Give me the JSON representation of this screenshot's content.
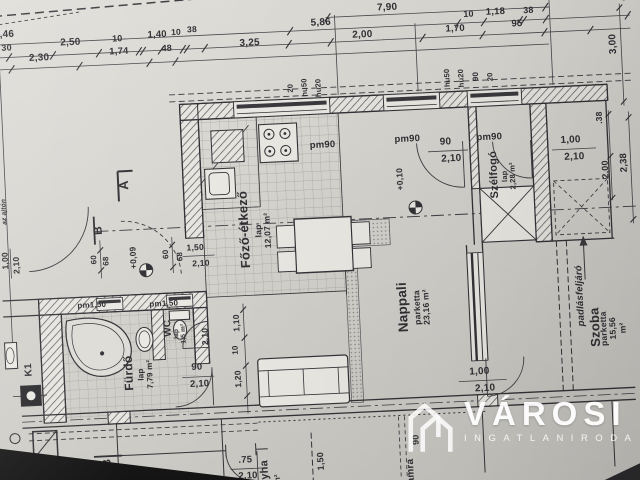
{
  "document": {
    "kind": "architectural floor plan photo",
    "language": "Hungarian"
  },
  "colors": {
    "paper": "#d8d6d1",
    "ink": "#3a3a3e",
    "watermark": "#ffffff",
    "window_fill": "#3a3a3e"
  },
  "watermark": {
    "brand": "VÁROSI",
    "subtitle": "INGATLANIRODA",
    "icon": "twin-tower-building-icon"
  },
  "rooms": [
    {
      "name": "Főző-étkező",
      "floor": "lap",
      "area": "12,07 m²"
    },
    {
      "name": "Nappali",
      "floor": "parketta",
      "area": "23,16 m²"
    },
    {
      "name": "Szélfogó",
      "floor": "lap",
      "area": "2,28 m²"
    },
    {
      "name": "Fürdő",
      "floor": "lap",
      "area": "7,79 m²"
    },
    {
      "name": "WC",
      "floor": "lap",
      "area": "1,5 m²"
    },
    {
      "name": "Szoba",
      "floor": "parketta",
      "area": "15,56 m²"
    },
    {
      "name": "Konyha",
      "floor": "",
      "area": ""
    },
    {
      "name": "kamra",
      "floor": "",
      "area": ""
    }
  ],
  "annotations": {
    "attic_access": "padlásfeljáró",
    "level_markers": [
      "+0,10",
      "+0,09"
    ],
    "section_markers": [
      "A",
      "B"
    ],
    "chimney": "K1",
    "door_specs": [
      "pm90",
      "90/2,10",
      "1,00/2,10",
      "pm1,50",
      "90/2,10",
      ".75/2,10",
      "1,50/2,10"
    ],
    "note": "az ajtón"
  },
  "plan": {
    "labels": [
      {
        "t": "7,90",
        "x": 398,
        "y": 11,
        "n": "dim-790"
      },
      {
        "t": "10",
        "x": 479,
        "y": 22,
        "s": 9
      },
      {
        "t": "1,18",
        "x": 506,
        "y": 21,
        "s": 9.5
      },
      {
        "t": "38",
        "x": 539,
        "y": 21,
        "s": 9
      },
      {
        "t": "8,46",
        "x": 14,
        "y": 20
      },
      {
        "t": "5,86",
        "x": 331,
        "y": 23
      },
      {
        "t": "95",
        "x": 527,
        "y": 34,
        "s": 9.5
      },
      {
        "t": "30",
        "x": 16,
        "y": 34,
        "s": 9
      },
      {
        "t": "2,50",
        "x": 80,
        "y": 31
      },
      {
        "t": "10",
        "x": 127,
        "y": 30,
        "s": 9
      },
      {
        "t": "1,40",
        "x": 167,
        "y": 28,
        "s": 9.5
      },
      {
        "t": "10",
        "x": 186,
        "y": 26,
        "s": 8.5
      },
      {
        "t": "38",
        "x": 202,
        "y": 24,
        "s": 8.5
      },
      {
        "t": "3,25",
        "x": 259,
        "y": 40
      },
      {
        "t": "2,00",
        "x": 372,
        "y": 37
      },
      {
        "t": "1,70",
        "x": 465,
        "y": 36,
        "s": 9.5
      },
      {
        "t": "2,30",
        "x": 48,
        "y": 45
      },
      {
        "t": "1,74",
        "x": 128,
        "y": 43,
        "s": 9.5
      },
      {
        "t": "48",
        "x": 176,
        "y": 42,
        "s": 9
      },
      {
        "t": "5",
        "x": 635,
        "y": 13,
        "s": 9.5
      },
      {
        "t": "3,00",
        "x": 622,
        "y": 58,
        "r": -90
      },
      {
        "t": ".38",
        "x": 605,
        "y": 131,
        "r": -90,
        "s": 8.5
      },
      {
        "t": "2,00",
        "x": 609,
        "y": 183,
        "r": -90,
        "s": 9
      },
      {
        "t": "2,38",
        "x": 628,
        "y": 177,
        "r": -90,
        "s": 9.5
      },
      {
        "t": "20",
        "x": 298,
        "y": 87,
        "r": -90,
        "s": 7.5
      },
      {
        "t": "hu50",
        "x": 312,
        "y": 87,
        "r": -90,
        "s": 7.5
      },
      {
        "t": "hu20",
        "x": 326,
        "y": 88,
        "r": -90,
        "s": 7.5
      },
      {
        "t": "hu50",
        "x": 455,
        "y": 84,
        "r": -90,
        "s": 7.5
      },
      {
        "t": "hu20",
        "x": 469,
        "y": 85,
        "r": -90,
        "s": 7.5
      },
      {
        "t": "90",
        "x": 484,
        "y": 84,
        "r": -90,
        "s": 8
      },
      {
        "t": "20",
        "x": 498,
        "y": 85,
        "r": -90,
        "s": 7.5
      },
      {
        "t": "pm90",
        "x": 327,
        "y": 146,
        "s": 9.5,
        "n": "window-spec-pm90"
      },
      {
        "t": "pm90",
        "x": 412,
        "y": 144,
        "s": 9.5,
        "n": "window-spec-pm90"
      },
      {
        "t": "90",
        "x": 450,
        "y": 148,
        "s": 10
      },
      {
        "t": "2,10",
        "x": 455,
        "y": 165,
        "s": 10
      },
      {
        "t": "pm90",
        "x": 494,
        "y": 146,
        "s": 9.5,
        "n": "window-spec-pm90"
      },
      {
        "t": "1,00",
        "x": 575,
        "y": 152,
        "s": 10
      },
      {
        "t": "2,10",
        "x": 578,
        "y": 169,
        "s": 10
      },
      {
        "t": "1,00",
        "x": 473,
        "y": 379,
        "s": 10
      },
      {
        "t": "2,10",
        "x": 478,
        "y": 396,
        "s": 10
      },
      {
        "t": "pm1,50",
        "x": 89,
        "y": 295,
        "s": 8,
        "n": "window-spec-pm150"
      },
      {
        "t": "pm1,50",
        "x": 161,
        "y": 297,
        "s": 8,
        "n": "window-spec-pm150"
      },
      {
        "t": "90",
        "x": 191,
        "y": 362,
        "s": 9.5
      },
      {
        "t": "2,10",
        "x": 193,
        "y": 379,
        "s": 9.5
      },
      {
        "t": ".75",
        "x": 235,
        "y": 457,
        "s": 9.5
      },
      {
        "t": "2,10",
        "x": 237,
        "y": 473,
        "s": 9.5
      },
      {
        "t": "1,50",
        "x": 311,
        "y": 461,
        "r": -90,
        "s": 9
      },
      {
        "t": "90",
        "x": 407,
        "y": 444,
        "r": -90,
        "s": 9
      },
      {
        "t": "1,00",
        "x": 5,
        "y": 246,
        "r": -90,
        "s": 8.5
      },
      {
        "t": "2,10",
        "x": 16,
        "y": 251,
        "r": -90,
        "s": 8.5
      },
      {
        "t": "60",
        "x": 94,
        "y": 249,
        "r": -90,
        "s": 8
      },
      {
        "t": "68",
        "x": 106,
        "y": 251,
        "r": -90,
        "s": 8
      },
      {
        "t": "60",
        "x": 166,
        "y": 247,
        "r": -90,
        "s": 8
      },
      {
        "t": "68",
        "x": 180,
        "y": 250,
        "r": -90,
        "s": 8
      },
      {
        "t": "1,50",
        "x": 195,
        "y": 242,
        "s": 8.5
      },
      {
        "t": "2,10",
        "x": 200,
        "y": 258,
        "s": 8.5
      },
      {
        "t": "2,10",
        "x": 201,
        "y": 331,
        "r": -90,
        "s": 8.5
      },
      {
        "t": "1,10",
        "x": 233,
        "y": 319,
        "r": -90,
        "s": 8.5
      },
      {
        "t": "10",
        "x": 231,
        "y": 346,
        "r": -90,
        "s": 8
      },
      {
        "t": "1,20",
        "x": 232,
        "y": 375,
        "r": -90,
        "s": 8.5
      },
      {
        "t": "+0,10",
        "x": 403,
        "y": 183,
        "r": -90,
        "s": 8.5,
        "n": "level-marker-010"
      },
      {
        "t": "+0,09",
        "x": 133,
        "y": 249,
        "r": -90,
        "s": 8.5,
        "n": "level-marker-009"
      },
      {
        "t": ".30",
        "x": 44,
        "y": 448,
        "s": 8
      },
      {
        "t": "Főző-étkező",
        "x": 245,
        "y": 226,
        "r": -90,
        "s": 13,
        "w": 700,
        "n": "room-label-fozo-etkezo"
      },
      {
        "t": "lap\n12,07 m²",
        "x": 264,
        "y": 228,
        "r": -90,
        "s": 8.5,
        "n": "room-area-fozo-etkezo"
      },
      {
        "t": "Nappali",
        "x": 400,
        "y": 311,
        "r": -90,
        "s": 13.5,
        "w": 700,
        "n": "room-label-nappali"
      },
      {
        "t": "parketta\n23,16 m²",
        "x": 419,
        "y": 312,
        "r": -90,
        "s": 8.5,
        "n": "room-area-nappali"
      },
      {
        "t": "Szélfogó",
        "x": 497,
        "y": 183,
        "r": -90,
        "s": 11,
        "w": 700,
        "n": "room-label-szelfogo"
      },
      {
        "t": "lap\n2,28 m²",
        "x": 512,
        "y": 185,
        "r": -90,
        "s": 7.5,
        "n": "room-area-szelfogo"
      },
      {
        "t": "Fürdő",
        "x": 123,
        "y": 364,
        "r": -90,
        "s": 12,
        "w": 700,
        "n": "room-label-furdo"
      },
      {
        "t": "lap\n7,79 m²",
        "x": 140,
        "y": 366,
        "r": -90,
        "s": 8,
        "n": "room-area-furdo"
      },
      {
        "t": "WC",
        "x": 164,
        "y": 321,
        "r": -90,
        "s": 10,
        "w": 700,
        "n": "room-label-wc"
      },
      {
        "t": "lap\n1,5 m²",
        "x": 176,
        "y": 327,
        "r": -90,
        "s": 6.5,
        "n": "room-area-wc"
      },
      {
        "t": "Szoba",
        "x": 591,
        "y": 340,
        "r": -90,
        "s": 13,
        "w": 700,
        "n": "room-label-szoba"
      },
      {
        "t": "parketta\n15,56 m²",
        "x": 609,
        "y": 342,
        "r": -90,
        "s": 8.5,
        "n": "room-area-szoba"
      },
      {
        "t": "padlásfeljáró",
        "x": 578,
        "y": 308,
        "r": -90,
        "s": 9.5,
        "w": 700,
        "i": 1,
        "n": "attic-access-label"
      },
      {
        "t": "Konyha",
        "x": 254,
        "y": 478,
        "r": -90,
        "s": 11,
        "w": 700,
        "n": "room-label-konyha"
      },
      {
        "t": "m²",
        "x": 267,
        "y": 477,
        "r": -90,
        "s": 8
      },
      {
        "t": "kamra",
        "x": 400,
        "y": 478,
        "r": -90,
        "s": 10,
        "w": 700,
        "n": "room-label-kamra"
      },
      {
        "t": "K1",
        "x": 23,
        "y": 356,
        "r": -90,
        "s": 10,
        "w": 700,
        "n": "chimney-label-k1"
      },
      {
        "t": "A",
        "x": 127,
        "y": 176,
        "r": -90,
        "s": 13,
        "w": 700,
        "n": "section-marker-a"
      },
      {
        "t": "B",
        "x": 99,
        "y": 220,
        "r": -90,
        "s": 12,
        "w": 700,
        "n": "section-marker-b"
      },
      {
        "t": "B",
        "x": 97,
        "y": 453,
        "r": -90,
        "s": 12,
        "w": 700,
        "n": "section-marker-b2"
      },
      {
        "t": "az ajtón",
        "x": 6,
        "y": 197,
        "r": -90,
        "s": 6.5,
        "i": 1,
        "n": "margin-note"
      }
    ]
  }
}
